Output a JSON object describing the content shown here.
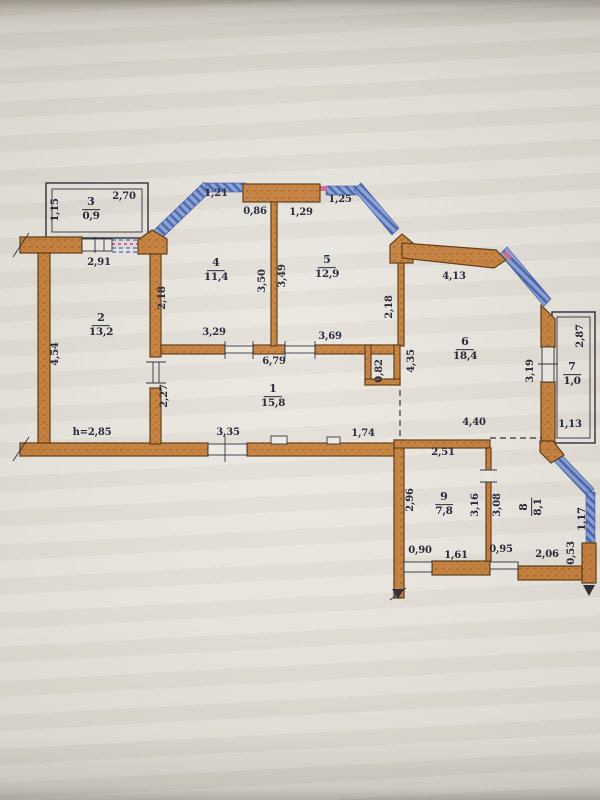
{
  "document": {
    "type": "apartment-floor-plan-photo",
    "units_note": "h=2,85"
  },
  "colors": {
    "wall": "#c8823f",
    "wall_shadow": "#9a5c20",
    "wall_outline": "#5f3a12",
    "window_blue": "#8aa3d8",
    "window_blue_dark": "#4a66b0",
    "accent_pink": "#d06a8c",
    "line": "#2c2c38",
    "text": "#232336",
    "paper": "#e9e6df"
  },
  "rooms": [
    {
      "number": "1",
      "area": "15,8",
      "x": 273,
      "y": 396,
      "rot": 0
    },
    {
      "number": "2",
      "area": "13,2",
      "x": 101,
      "y": 325,
      "rot": 0
    },
    {
      "number": "3",
      "area": "0,9",
      "x": 91,
      "y": 209,
      "rot": 0
    },
    {
      "number": "4",
      "area": "11,4",
      "x": 216,
      "y": 270,
      "rot": 0
    },
    {
      "number": "5",
      "area": "12,9",
      "x": 327,
      "y": 267,
      "rot": 0
    },
    {
      "number": "6",
      "area": "18,4",
      "x": 465,
      "y": 349,
      "rot": 0
    },
    {
      "number": "7",
      "area": "1,0",
      "x": 572,
      "y": 374,
      "rot": 0
    },
    {
      "number": "8",
      "area": "8,1",
      "x": 531,
      "y": 507,
      "rot": -90
    },
    {
      "number": "9",
      "area": "7,8",
      "x": 444,
      "y": 504,
      "rot": 0
    }
  ],
  "dimensions": [
    {
      "text": "2,70",
      "x": 124,
      "y": 197,
      "rot": 0
    },
    {
      "text": "1,15",
      "x": 56,
      "y": 210,
      "rot": -90
    },
    {
      "text": "2,91",
      "x": 99,
      "y": 263,
      "rot": 0
    },
    {
      "text": "1,21",
      "x": 216,
      "y": 194,
      "rot": 0
    },
    {
      "text": "0,86",
      "x": 255,
      "y": 212,
      "rot": 0
    },
    {
      "text": "1,29",
      "x": 301,
      "y": 213,
      "rot": 0
    },
    {
      "text": "1,25",
      "x": 340,
      "y": 200,
      "rot": 0
    },
    {
      "text": "4,13",
      "x": 454,
      "y": 277,
      "rot": 0
    },
    {
      "text": "2,18",
      "x": 163,
      "y": 298,
      "rot": -90
    },
    {
      "text": "3,50",
      "x": 263,
      "y": 281,
      "rot": -90
    },
    {
      "text": "3,49",
      "x": 283,
      "y": 276,
      "rot": -90
    },
    {
      "text": "2,18",
      "x": 390,
      "y": 307,
      "rot": -90
    },
    {
      "text": "4,54",
      "x": 56,
      "y": 354,
      "rot": -90
    },
    {
      "text": "3,29",
      "x": 214,
      "y": 333,
      "rot": 0
    },
    {
      "text": "3,69",
      "x": 330,
      "y": 337,
      "rot": 0
    },
    {
      "text": "6,79",
      "x": 274,
      "y": 362,
      "rot": 0
    },
    {
      "text": "0,82",
      "x": 380,
      "y": 371,
      "rot": -90
    },
    {
      "text": "4,35",
      "x": 412,
      "y": 361,
      "rot": -90
    },
    {
      "text": "2,27",
      "x": 165,
      "y": 396,
      "rot": -90
    },
    {
      "text": "3,19",
      "x": 531,
      "y": 371,
      "rot": -90
    },
    {
      "text": "2,87",
      "x": 581,
      "y": 336,
      "rot": -90
    },
    {
      "text": "1,13",
      "x": 570,
      "y": 425,
      "rot": 0
    },
    {
      "text": "h=2,85",
      "x": 92,
      "y": 433,
      "rot": 0
    },
    {
      "text": "3,35",
      "x": 228,
      "y": 433,
      "rot": 0
    },
    {
      "text": "1,74",
      "x": 363,
      "y": 434,
      "rot": 0
    },
    {
      "text": "4,40",
      "x": 474,
      "y": 423,
      "rot": 0
    },
    {
      "text": "2,51",
      "x": 443,
      "y": 453,
      "rot": 0
    },
    {
      "text": "2,96",
      "x": 411,
      "y": 500,
      "rot": -90
    },
    {
      "text": "3,16",
      "x": 476,
      "y": 505,
      "rot": -90
    },
    {
      "text": "3,08",
      "x": 498,
      "y": 505,
      "rot": -90
    },
    {
      "text": "1,17",
      "x": 583,
      "y": 519,
      "rot": -90
    },
    {
      "text": "0,90",
      "x": 420,
      "y": 551,
      "rot": 0
    },
    {
      "text": "1,61",
      "x": 456,
      "y": 556,
      "rot": 0
    },
    {
      "text": "0,95",
      "x": 501,
      "y": 550,
      "rot": 0
    },
    {
      "text": "2,06",
      "x": 547,
      "y": 555,
      "rot": 0
    },
    {
      "text": "0,53",
      "x": 572,
      "y": 553,
      "rot": -90
    }
  ]
}
